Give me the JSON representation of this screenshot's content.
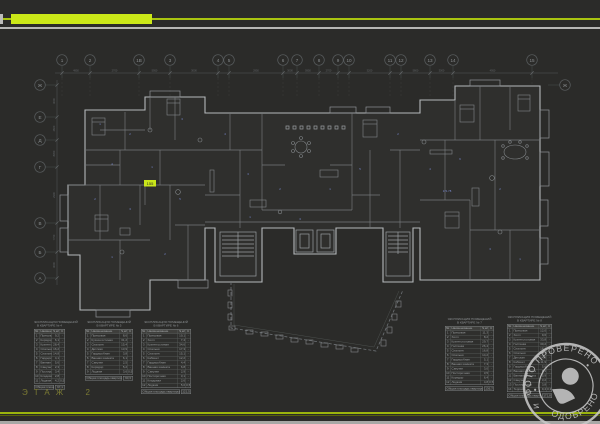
{
  "footer": {
    "floor_label": "ЭТАЖ  2"
  },
  "accent": {
    "bar_color": "#cbe818",
    "line_color": "#a9c410"
  },
  "grid": {
    "top_labels": [
      "1",
      "2",
      "1В",
      "3",
      "4",
      "5",
      "6",
      "7",
      "8",
      "9",
      "10",
      "11",
      "12",
      "13",
      "14",
      "15"
    ],
    "left_labels": [
      "Ж",
      "Е",
      "Д",
      "Г",
      "В",
      "Б",
      "А"
    ],
    "right_labels": [
      "Ж"
    ]
  },
  "dimensions": {
    "top_row": [
      "4950",
      "2700",
      "5950",
      "3000",
      "5950",
      "2950",
      "3000",
      "5950",
      "2700",
      "4950",
      "3200",
      "2950",
      "5800",
      "3000",
      "4950"
    ],
    "left_column": [
      "3000",
      "2600",
      "8350",
      "2300",
      "7750",
      "3000"
    ]
  },
  "room_tags": [
    "1",
    "2",
    "3",
    "4",
    "1",
    "2",
    "3",
    "5",
    "1",
    "2",
    "4",
    "3",
    "2",
    "1",
    "5",
    "3",
    "1",
    "2",
    "4",
    "6",
    "2",
    "3",
    "1",
    "171.78"
  ],
  "highlight_tag": {
    "label": "155",
    "color": "#c9e61a"
  },
  "tables": {
    "title_line1": "ЭКСПЛИКАЦИЯ ПОМЕЩЕНИЙ",
    "header": {
      "no": "№",
      "name": "Наименование",
      "v1": "S,м²",
      "v2": "К"
    },
    "list": [
      {
        "subtitle": "В КВАРТИРЕ № 4",
        "rows": [
          [
            "1",
            "Прихожая",
            "9,2",
            "-"
          ],
          [
            "2",
            "Коридор",
            "6,1",
            "-"
          ],
          [
            "3",
            "Кухня-гостиная",
            "28,4",
            "-"
          ],
          [
            "4",
            "Спальня",
            "16,2",
            "-"
          ],
          [
            "5",
            "Спальня",
            "14,8",
            "-"
          ],
          [
            "6",
            "Гардеробная",
            "4,1",
            "-"
          ],
          [
            "7",
            "Ванная комната",
            "5,6",
            "-"
          ],
          [
            "8",
            "Санузел",
            "2,3",
            "-"
          ],
          [
            "9",
            "Постирочная",
            "3,4",
            "-"
          ],
          [
            "10",
            "Кладовая",
            "2,8",
            "-"
          ],
          [
            "11",
            "Лоджия",
            "4,2",
            "0,5"
          ]
        ],
        "total_label": "Общая площадь квартиры",
        "total_value": "97,1"
      },
      {
        "subtitle": "В КВАРТИРЕ № 5",
        "rows": [
          [
            "1",
            "Прихожая",
            "8,6",
            "-"
          ],
          [
            "2",
            "Кухня-гостиная",
            "31,2",
            "-"
          ],
          [
            "3",
            "Спальня",
            "15,4",
            "-"
          ],
          [
            "4",
            "Детская",
            "13,9",
            "-"
          ],
          [
            "5",
            "Гардеробная",
            "3,8",
            "-"
          ],
          [
            "6",
            "Ванная комната",
            "6,1",
            "-"
          ],
          [
            "7",
            "Санузел",
            "2,5",
            "-"
          ],
          [
            "8",
            "Коридор",
            "5,2",
            "-"
          ],
          [
            "9",
            "Лоджия",
            "3,6",
            "0,5"
          ]
        ],
        "total_label": "Общая площадь квартиры",
        "total_value": "90,3"
      },
      {
        "subtitle": "В КВАРТИРЕ № 6",
        "rows": [
          [
            "1",
            "Прихожая",
            "10,1",
            "-"
          ],
          [
            "2",
            "Холл",
            "7,4",
            "-"
          ],
          [
            "3",
            "Кухня-гостиная",
            "34,6",
            "-"
          ],
          [
            "4",
            "Спальня",
            "17,3",
            "-"
          ],
          [
            "5",
            "Спальня",
            "15,1",
            "-"
          ],
          [
            "6",
            "Кабинет",
            "12,2",
            "-"
          ],
          [
            "7",
            "Гардеробная",
            "4,4",
            "-"
          ],
          [
            "8",
            "Ванная комната",
            "6,8",
            "-"
          ],
          [
            "9",
            "Санузел",
            "2,9",
            "-"
          ],
          [
            "10",
            "Постирочная",
            "3,1",
            "-"
          ],
          [
            "11",
            "Кладовая",
            "2,6",
            "-"
          ],
          [
            "12",
            "Лоджия",
            "5,0",
            "0,5"
          ]
        ],
        "total_label": "Общая площадь квартиры",
        "total_value": "121,5"
      },
      {
        "subtitle": "В КВАРТИРЕ № 7",
        "rows": [
          [
            "1",
            "Прихожая",
            "11,3",
            "-"
          ],
          [
            "2",
            "Холл",
            "8,2",
            "-"
          ],
          [
            "3",
            "Кухня-столовая",
            "29,7",
            "-"
          ],
          [
            "4",
            "Гостиная",
            "26,4",
            "-"
          ],
          [
            "5",
            "Спальня",
            "16,8",
            "-"
          ],
          [
            "6",
            "Спальня",
            "14,2",
            "-"
          ],
          [
            "7",
            "Гардеробная",
            "5,1",
            "-"
          ],
          [
            "8",
            "Ванная комната",
            "7,3",
            "-"
          ],
          [
            "9",
            "Санузел",
            "3,0",
            "-"
          ],
          [
            "10",
            "Постирочная",
            "3,5",
            "-"
          ],
          [
            "11",
            "Коридор",
            "6,4",
            "-"
          ],
          [
            "12",
            "Лоджия",
            "4,8",
            "0,5"
          ]
        ],
        "total_label": "Общая площадь квартиры",
        "total_value": "136,7"
      },
      {
        "subtitle": "В КВАРТИРЕ № 8",
        "rows": [
          [
            "1",
            "Прихожая",
            "12,0",
            "-"
          ],
          [
            "2",
            "Холл",
            "9,6",
            "-"
          ],
          [
            "3",
            "Кухня-столовая",
            "33,8",
            "-"
          ],
          [
            "4",
            "Гостиная",
            "30,2",
            "-"
          ],
          [
            "5",
            "Спальня",
            "18,4",
            "-"
          ],
          [
            "6",
            "Спальня",
            "15,7",
            "-"
          ],
          [
            "7",
            "Детская",
            "14,3",
            "-"
          ],
          [
            "8",
            "Кабинет",
            "11,9",
            "-"
          ],
          [
            "9",
            "Гардеробная",
            "5,6",
            "-"
          ],
          [
            "10",
            "Ванная комната",
            "8,1",
            "-"
          ],
          [
            "11",
            "Ванная комната",
            "5,9",
            "-"
          ],
          [
            "12",
            "Санузел",
            "3,2",
            "-"
          ],
          [
            "13",
            "Постирочная",
            "3,8",
            "-"
          ],
          [
            "14",
            "Терраса",
            "9,4",
            "0,3"
          ]
        ],
        "total_label": "Общая площадь квартиры",
        "total_value": "171,8"
      }
    ]
  },
  "stamp": {
    "top_text": "ФОТО ПРОВЕРЕНО",
    "bottom_text": "ОДОБРЕНО",
    "side_left": "И",
    "separator": "•"
  }
}
